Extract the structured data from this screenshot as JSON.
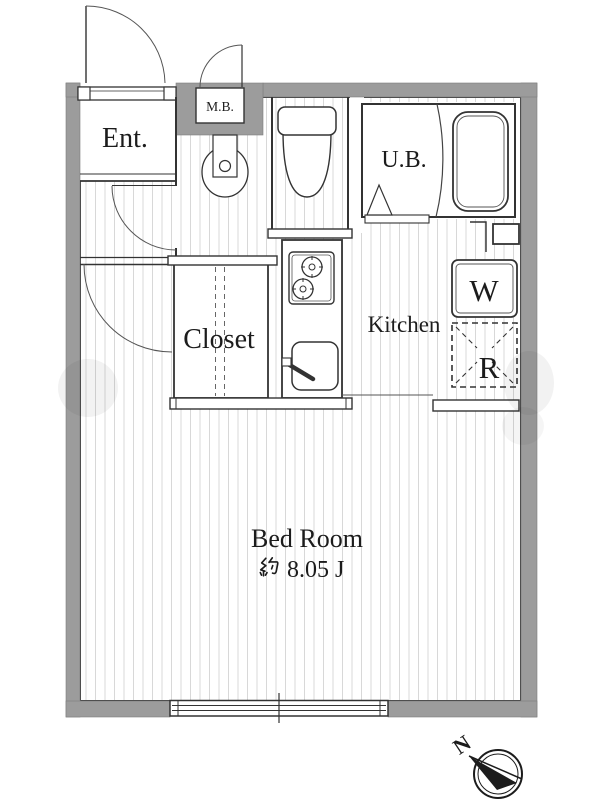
{
  "colors": {
    "wall_gray": "#9c9c9c",
    "line_dark": "#333333",
    "floor_stripe": "#d8d8d8",
    "text": "#1c1c1c"
  },
  "rooms": {
    "entrance": {
      "label": "Ent."
    },
    "meter_box": {
      "label": "M.B."
    },
    "unit_bath": {
      "label": "U.B."
    },
    "closet": {
      "label": "Closet"
    },
    "kitchen": {
      "label": "Kitchen"
    },
    "washer": {
      "label": "W"
    },
    "refrigerator": {
      "label": "R"
    },
    "bedroom": {
      "label": "Bed Room",
      "area_label": "約 8.05 J",
      "area_prefix_kanji": "約",
      "area_value": "8.05 J"
    }
  },
  "compass": {
    "north_label": "N"
  },
  "fixtures": [
    "entrance-door",
    "meter-box-door",
    "washbasin",
    "toilet",
    "bathtub",
    "unit-bath-folding-door",
    "gas-stove",
    "kitchen-sink",
    "washing-machine-space",
    "refrigerator-space",
    "pipe-space",
    "closet-folding-doors",
    "sliding-window"
  ]
}
